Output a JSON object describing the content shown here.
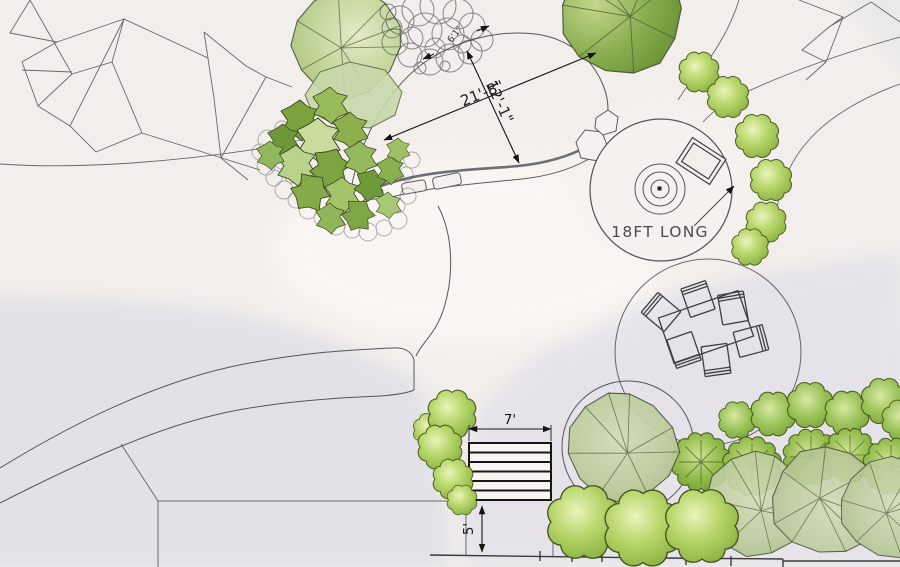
{
  "plan": {
    "annotations": {
      "dim_main": "21'-8\"",
      "dim_cross": "12'-1\"",
      "dim_path": "6'1\"",
      "patio_callout": "18FT LONG",
      "steps_width": "7'",
      "steps_depth": "5'"
    },
    "colors": {
      "paper": "#f2eeeb",
      "shade_gray": "#e3e2e8",
      "line": "#55565a",
      "ink": "#1a1a1a",
      "foliage_bright": "#8fb545",
      "foliage_mid": "#7da33c",
      "foliage_light": "#c8d8ab",
      "foliage_sage": "#b9c998",
      "foliage_dark": "#6d9638"
    }
  }
}
